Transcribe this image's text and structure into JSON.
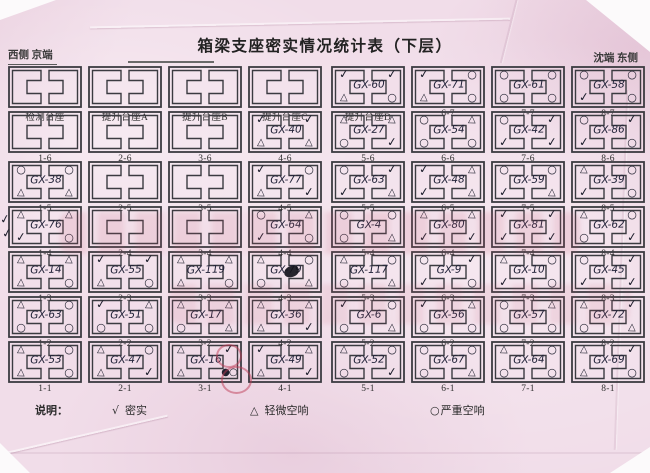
{
  "page": {
    "title": "箱梁支座密实情况统计表（下层）",
    "corner_left": "西侧 京端",
    "corner_right": "沈端 东侧"
  },
  "symbols": {
    "check": "✓",
    "triangle": "△",
    "circle": "○",
    "blob": "●○"
  },
  "legend": {
    "label": "说明：",
    "items": [
      {
        "symbol": "√",
        "text": "密实"
      },
      {
        "symbol": "△",
        "text": "轻微空响"
      },
      {
        "symbol": "○",
        "text": "严重空响"
      }
    ]
  },
  "stray_marks": [
    {
      "mark": "check",
      "near": "left margin beside 1-4"
    },
    {
      "mark": "check",
      "near": "left margin beside 1-5"
    }
  ],
  "grid": {
    "rows": [
      {
        "cells": [
          {
            "label": "检测台座",
            "gx": "",
            "marks": null
          },
          {
            "label": "提升台座A",
            "gx": "",
            "marks": null
          },
          {
            "label": "提升台座B",
            "gx": "",
            "marks": null
          },
          {
            "label": "提升台座C",
            "gx": "",
            "marks": null
          },
          {
            "label": "提升台座D",
            "gx": "GX-60",
            "marks": {
              "tl": "check",
              "tr": "check",
              "bl": "triangle",
              "br": "circle"
            }
          },
          {
            "label": "6-7",
            "gx": "GX-71",
            "marks": {
              "tl": "check",
              "tr": "circle",
              "bl": "triangle",
              "br": "circle"
            }
          },
          {
            "label": "7-7",
            "gx": "GX-61",
            "marks": {
              "tl": "circle",
              "tr": "circle",
              "bl": "circle",
              "br": "circle"
            }
          },
          {
            "label": "8-7",
            "gx": "GX-58",
            "marks": {
              "tl": "circle",
              "tr": "circle",
              "bl": "check",
              "br": "circle"
            }
          }
        ]
      },
      {
        "cells": [
          {
            "label": "1-6",
            "gx": "",
            "marks": null
          },
          {
            "label": "2-6",
            "gx": "",
            "marks": null
          },
          {
            "label": "3-6",
            "gx": "",
            "marks": null
          },
          {
            "label": "4-6",
            "gx": "GX-40",
            "marks": {
              "tl": "check",
              "tr": "check",
              "bl": "triangle",
              "br": "triangle"
            }
          },
          {
            "label": "5-6",
            "gx": "GX-27",
            "marks": {
              "tl": "triangle",
              "tr": "triangle",
              "bl": "circle",
              "br": "check"
            }
          },
          {
            "label": "6-6",
            "gx": "GX-54",
            "marks": {
              "tl": "circle",
              "tr": "triangle",
              "bl": "circle",
              "br": "circle"
            }
          },
          {
            "label": "7-6",
            "gx": "GX-42",
            "marks": {
              "tl": "circle",
              "tr": "check",
              "bl": "check",
              "br": "check"
            }
          },
          {
            "label": "8-6",
            "gx": "GX-86",
            "marks": {
              "tl": "circle",
              "tr": "check",
              "bl": "check",
              "br": "circle"
            }
          }
        ]
      },
      {
        "cells": [
          {
            "label": "1-5",
            "gx": "GX-38",
            "marks": {
              "tl": "circle",
              "tr": "circle",
              "bl": "triangle",
              "br": "triangle"
            }
          },
          {
            "label": "2-5",
            "gx": "",
            "marks": null
          },
          {
            "label": "3-5",
            "gx": "",
            "marks": null
          },
          {
            "label": "4-5",
            "gx": "GX-77",
            "marks": {
              "tl": "check",
              "tr": "circle",
              "bl": "triangle",
              "br": "check"
            }
          },
          {
            "label": "5-5",
            "gx": "GX-63",
            "marks": {
              "tl": "circle",
              "tr": "check",
              "bl": "check",
              "br": "triangle"
            }
          },
          {
            "label": "6-5",
            "gx": "GX-48",
            "marks": {
              "tl": "check",
              "tr": "triangle",
              "bl": "check",
              "br": "triangle"
            }
          },
          {
            "label": "7-5",
            "gx": "GX-59",
            "marks": {
              "tl": "circle",
              "tr": "circle",
              "bl": "check",
              "br": "triangle"
            }
          },
          {
            "label": "8-5",
            "gx": "GX-39",
            "marks": {
              "tl": "triangle",
              "tr": "circle",
              "bl": "check",
              "br": "circle"
            }
          }
        ]
      },
      {
        "cells": [
          {
            "label": "1-4",
            "gx": "GX-76",
            "marks": {
              "tl": "triangle",
              "tr": "triangle",
              "bl": "check",
              "br": "circle"
            }
          },
          {
            "label": "2-4",
            "gx": "",
            "marks": null
          },
          {
            "label": "3-4",
            "gx": "",
            "marks": null
          },
          {
            "label": "4-4",
            "gx": "GX-64",
            "marks": {
              "tl": "circle",
              "tr": "triangle",
              "bl": "check",
              "br": "circle"
            }
          },
          {
            "label": "5-4",
            "gx": "GX-4",
            "marks": {
              "tl": "circle",
              "tr": "circle",
              "bl": "circle",
              "br": "triangle"
            }
          },
          {
            "label": "6-4",
            "gx": "GX-80",
            "marks": {
              "tl": "triangle",
              "tr": "triangle",
              "bl": "check",
              "br": "check"
            }
          },
          {
            "label": "7-4",
            "gx": "GX-81",
            "marks": {
              "tl": "check",
              "tr": "check",
              "bl": "check",
              "br": "check"
            }
          },
          {
            "label": "8-4",
            "gx": "GX-62",
            "marks": {
              "tl": "triangle",
              "tr": "circle",
              "bl": "circle",
              "br": "check"
            }
          }
        ]
      },
      {
        "cells": [
          {
            "label": "1-3",
            "gx": "GX-14",
            "marks": {
              "tl": "triangle",
              "tr": "triangle",
              "bl": "triangle",
              "br": "circle"
            }
          },
          {
            "label": "2-3",
            "gx": "GX-55",
            "marks": {
              "tl": "check",
              "tr": "check",
              "bl": "triangle",
              "br": "circle"
            }
          },
          {
            "label": "3-3",
            "gx": "GX-119",
            "marks": {
              "tl": "triangle",
              "tr": "triangle",
              "bl": "triangle",
              "br": "circle"
            }
          },
          {
            "label": "4-3",
            "gx": "GX-79",
            "blot": true,
            "marks": {
              "tl": "triangle",
              "tr": "circle",
              "bl": "circle",
              "br": "triangle"
            }
          },
          {
            "label": "5-3",
            "gx": "GX-117",
            "marks": {
              "tl": "triangle",
              "tr": "circle",
              "bl": "circle",
              "br": "triangle"
            }
          },
          {
            "label": "6-3",
            "gx": "GX-9",
            "marks": {
              "tl": "circle",
              "tr": "check",
              "bl": "check",
              "br": "circle"
            }
          },
          {
            "label": "7-3",
            "gx": "GX-10",
            "marks": {
              "tl": "triangle",
              "tr": "circle",
              "bl": "check",
              "br": "circle"
            }
          },
          {
            "label": "8-3",
            "gx": "GX-45",
            "marks": {
              "tl": "circle",
              "tr": "check",
              "bl": "check",
              "br": "check"
            }
          }
        ]
      },
      {
        "cells": [
          {
            "label": "1-2",
            "gx": "GX-63",
            "marks": {
              "tl": "triangle",
              "tr": "circle",
              "bl": "circle",
              "br": "circle"
            }
          },
          {
            "label": "2-2",
            "gx": "GX-51",
            "marks": {
              "tl": "check",
              "tr": "triangle",
              "bl": "circle",
              "br": "circle"
            }
          },
          {
            "label": "3-2",
            "gx": "GX-17",
            "marks": {
              "tl": "triangle",
              "tr": "triangle",
              "bl": "circle",
              "br": "triangle"
            }
          },
          {
            "label": "4-2",
            "gx": "GX-36",
            "marks": {
              "tl": "triangle",
              "tr": "triangle",
              "bl": "triangle",
              "br": "check"
            }
          },
          {
            "label": "5-2",
            "gx": "GX-6",
            "marks": {
              "tl": "check",
              "tr": "circle",
              "bl": "circle",
              "br": "triangle"
            }
          },
          {
            "label": "6-2",
            "gx": "GX-56",
            "marks": {
              "tl": "check",
              "tr": "triangle",
              "bl": "circle",
              "br": "circle"
            }
          },
          {
            "label": "7-2",
            "gx": "GX-57",
            "marks": {
              "tl": "circle",
              "tr": "triangle",
              "bl": "circle",
              "br": "circle"
            }
          },
          {
            "label": "8-2",
            "gx": "GX-72",
            "marks": {
              "tl": "triangle",
              "tr": "check",
              "bl": "circle",
              "br": "triangle"
            }
          }
        ]
      },
      {
        "cells": [
          {
            "label": "1-1",
            "gx": "GX-53",
            "marks": {
              "tl": "triangle",
              "tr": "circle",
              "bl": "triangle",
              "br": "circle"
            }
          },
          {
            "label": "2-1",
            "gx": "GX-47",
            "marks": {
              "tl": "triangle",
              "tr": "circle",
              "bl": "triangle",
              "br": "check"
            }
          },
          {
            "label": "3-1",
            "gx": "GX-16",
            "marks": {
              "tl": "triangle",
              "tr": "check",
              "bl": "triangle",
              "br": "blob"
            }
          },
          {
            "label": "4-1",
            "gx": "GX-49",
            "marks": {
              "tl": "check",
              "tr": "triangle",
              "bl": "triangle",
              "br": "check"
            }
          },
          {
            "label": "5-1",
            "gx": "GX-52",
            "marks": {
              "tl": "triangle",
              "tr": "circle",
              "bl": "circle",
              "br": "check"
            }
          },
          {
            "label": "6-1",
            "gx": "GX-67",
            "marks": {
              "tl": "circle",
              "tr": "circle",
              "bl": "circle",
              "br": "triangle"
            }
          },
          {
            "label": "7-1",
            "gx": "GX-64",
            "marks": {
              "tl": "triangle",
              "tr": "circle",
              "bl": "circle",
              "br": "circle"
            }
          },
          {
            "label": "8-1",
            "gx": "GX-69",
            "marks": {
              "tl": "triangle",
              "tr": "check",
              "bl": "triangle",
              "br": "circle"
            }
          }
        ]
      }
    ]
  }
}
